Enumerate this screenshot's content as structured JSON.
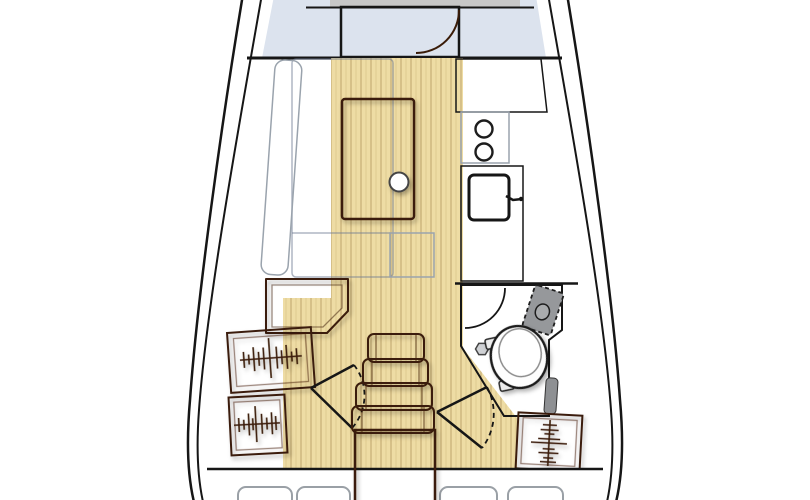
{
  "plan": {
    "type": "sailboat-interior-floor-plan",
    "orientation": "bow-up"
  },
  "colors": {
    "background": "#ffffff",
    "outline": "#161616",
    "hull_gap": "#ffffff",
    "wood": "#b4612e",
    "wood_dark": "#9c5226",
    "floor": "#eedca4",
    "berth_blue": "#dce3ee",
    "berth_shelf_gray": "#c7c7c7",
    "backrest_white": "#f4f6f8",
    "nav_seat": "#edf0f4",
    "counter_gray": "#57585a",
    "stove_panel": "#ffffff",
    "sink_basin": "#505153",
    "head_floor": "#d5d7da",
    "toilet_white": "#fdfdfd",
    "fixture_gray": "#96989b",
    "fixture_slot": "#8e9093",
    "cushion_white": "#ffffff"
  },
  "icons": {
    "stove_burners": "two-circles",
    "galley_sink": "square-basin-with-faucet",
    "head_sink": "dashed-tilted-basin",
    "toilet": "double-oval",
    "drain": "hexagon",
    "door_swing": "quarter-arc",
    "aft_door_swing": "wedge-with-dashed-arc",
    "hanging_locker": "rod-with-hanger-hatching",
    "companionway": "stacked-steps"
  }
}
